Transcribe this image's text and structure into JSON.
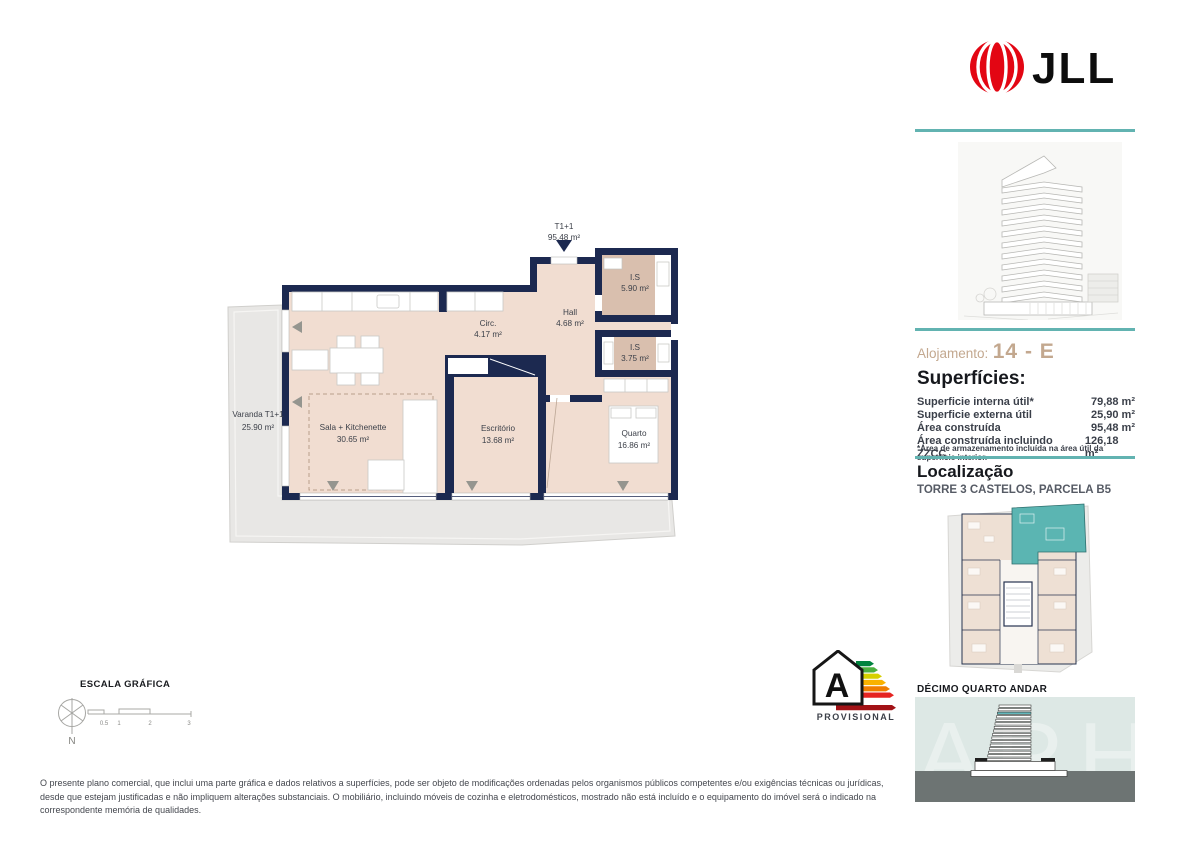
{
  "logo": {
    "brand": "JLL"
  },
  "plan": {
    "unit": {
      "type": "T1+1",
      "area": "95.48 m²"
    },
    "rooms": [
      {
        "name": "I.S",
        "area": "5.90 m²"
      },
      {
        "name": "Hall",
        "area": "4.68 m²"
      },
      {
        "name": "Circ.",
        "area": "4.17 m²"
      },
      {
        "name": "I.S",
        "area": "3.75 m²"
      },
      {
        "name": "Sala + Kitchenette",
        "area": "30.65 m²"
      },
      {
        "name": "Escritório",
        "area": "13.68 m²"
      },
      {
        "name": "Quarto",
        "area": "16.86 m²"
      },
      {
        "name": "Varanda T1+1",
        "area": "25.90 m²"
      }
    ]
  },
  "scale_bar": {
    "title": "ESCALA GRÁFICA",
    "north": "N",
    "ticks": [
      "0.5",
      "1",
      "2",
      "3"
    ]
  },
  "energy": {
    "rating": "A",
    "status": "PROVISIONAL",
    "colors": [
      "#00833e",
      "#4caf3e",
      "#d6d000",
      "#f9b200",
      "#ef7d00",
      "#e52421",
      "#a21216"
    ]
  },
  "sidebar": {
    "alojamento_label": "Alojamento:",
    "alojamento_value": "14 - E",
    "superficies_title": "Superfícies:",
    "areas": [
      {
        "label": "Superficie interna útil*",
        "value": "79,88 m²"
      },
      {
        "label": "Superficie externa útil",
        "value": "25,90 m²"
      },
      {
        "label": "Área construída",
        "value": "95,48 m²"
      },
      {
        "label": "Área construída incluindo ZZCC",
        "value": "126,18 m²"
      }
    ],
    "footnote": "*Área de armazenamento incluída na área útil da superfície interior.",
    "localizacao_title": "Localização",
    "localizacao_subtitle": "TORRE 3 CASTELOS, PARCELA B5",
    "floor_label": "DÉCIMO QUARTO ANDAR",
    "watermark": "ARH"
  },
  "disclaimer": "O presente plano comercial, que inclui uma parte gráfica e dados relativos a superfícies, pode ser objeto de modificações ordenadas pelos organismos públicos competentes e/ou exigências técnicas ou jurídicas, desde que estejam justificadas e não impliquem alterações substanciais. O mobiliário, incluindo móveis de cozinha e eletrodomésticos, mostrado não está incluído e o equipamento do imóvel será o indicado na correspondente memória de qualidades."
}
